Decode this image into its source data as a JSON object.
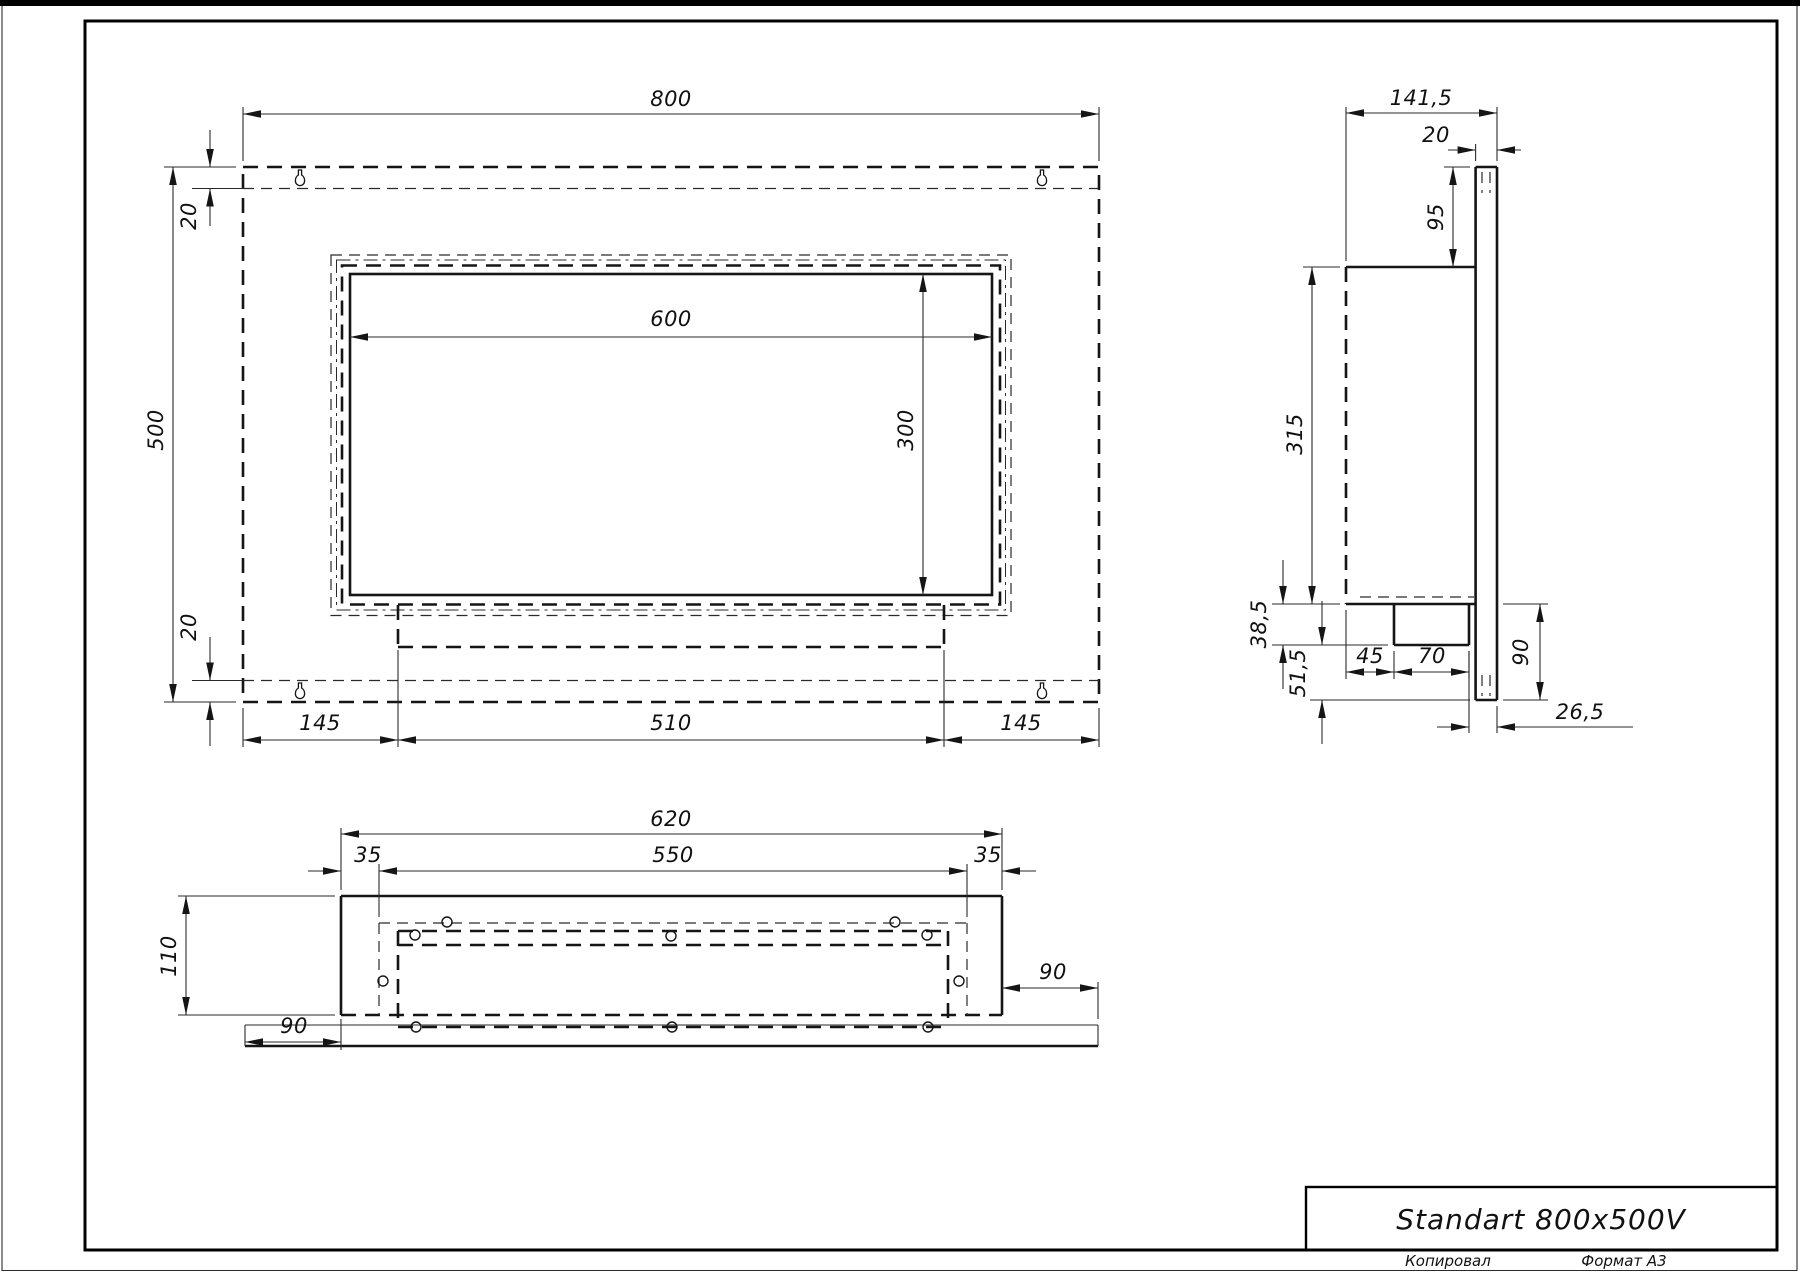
{
  "drawing": {
    "title": "Standart 800x500V",
    "stamp": {
      "copied": "Копировал",
      "format": "Формат A3"
    },
    "front_view": {
      "width": "800",
      "height": "500",
      "top_offset": "20",
      "bottom_offset": "20",
      "opening_width": "600",
      "opening_height": "300",
      "left_margin": "145",
      "burner_width": "510",
      "right_margin": "145"
    },
    "side_view": {
      "depth": "141,5",
      "plate_thickness": "20",
      "top_to_box": "95",
      "box_height": "315",
      "shelf_height": "38,5",
      "lower_height": "51,5",
      "tray_offset": "45",
      "tray_width": "70",
      "plate_below_box": "90",
      "tray_to_edge": "26,5"
    },
    "bottom_view": {
      "outer_width": "620",
      "left_side": "35",
      "inner_width": "550",
      "right_side": "35",
      "depth": "110",
      "wing_left": "90",
      "wing_right": "90"
    }
  }
}
